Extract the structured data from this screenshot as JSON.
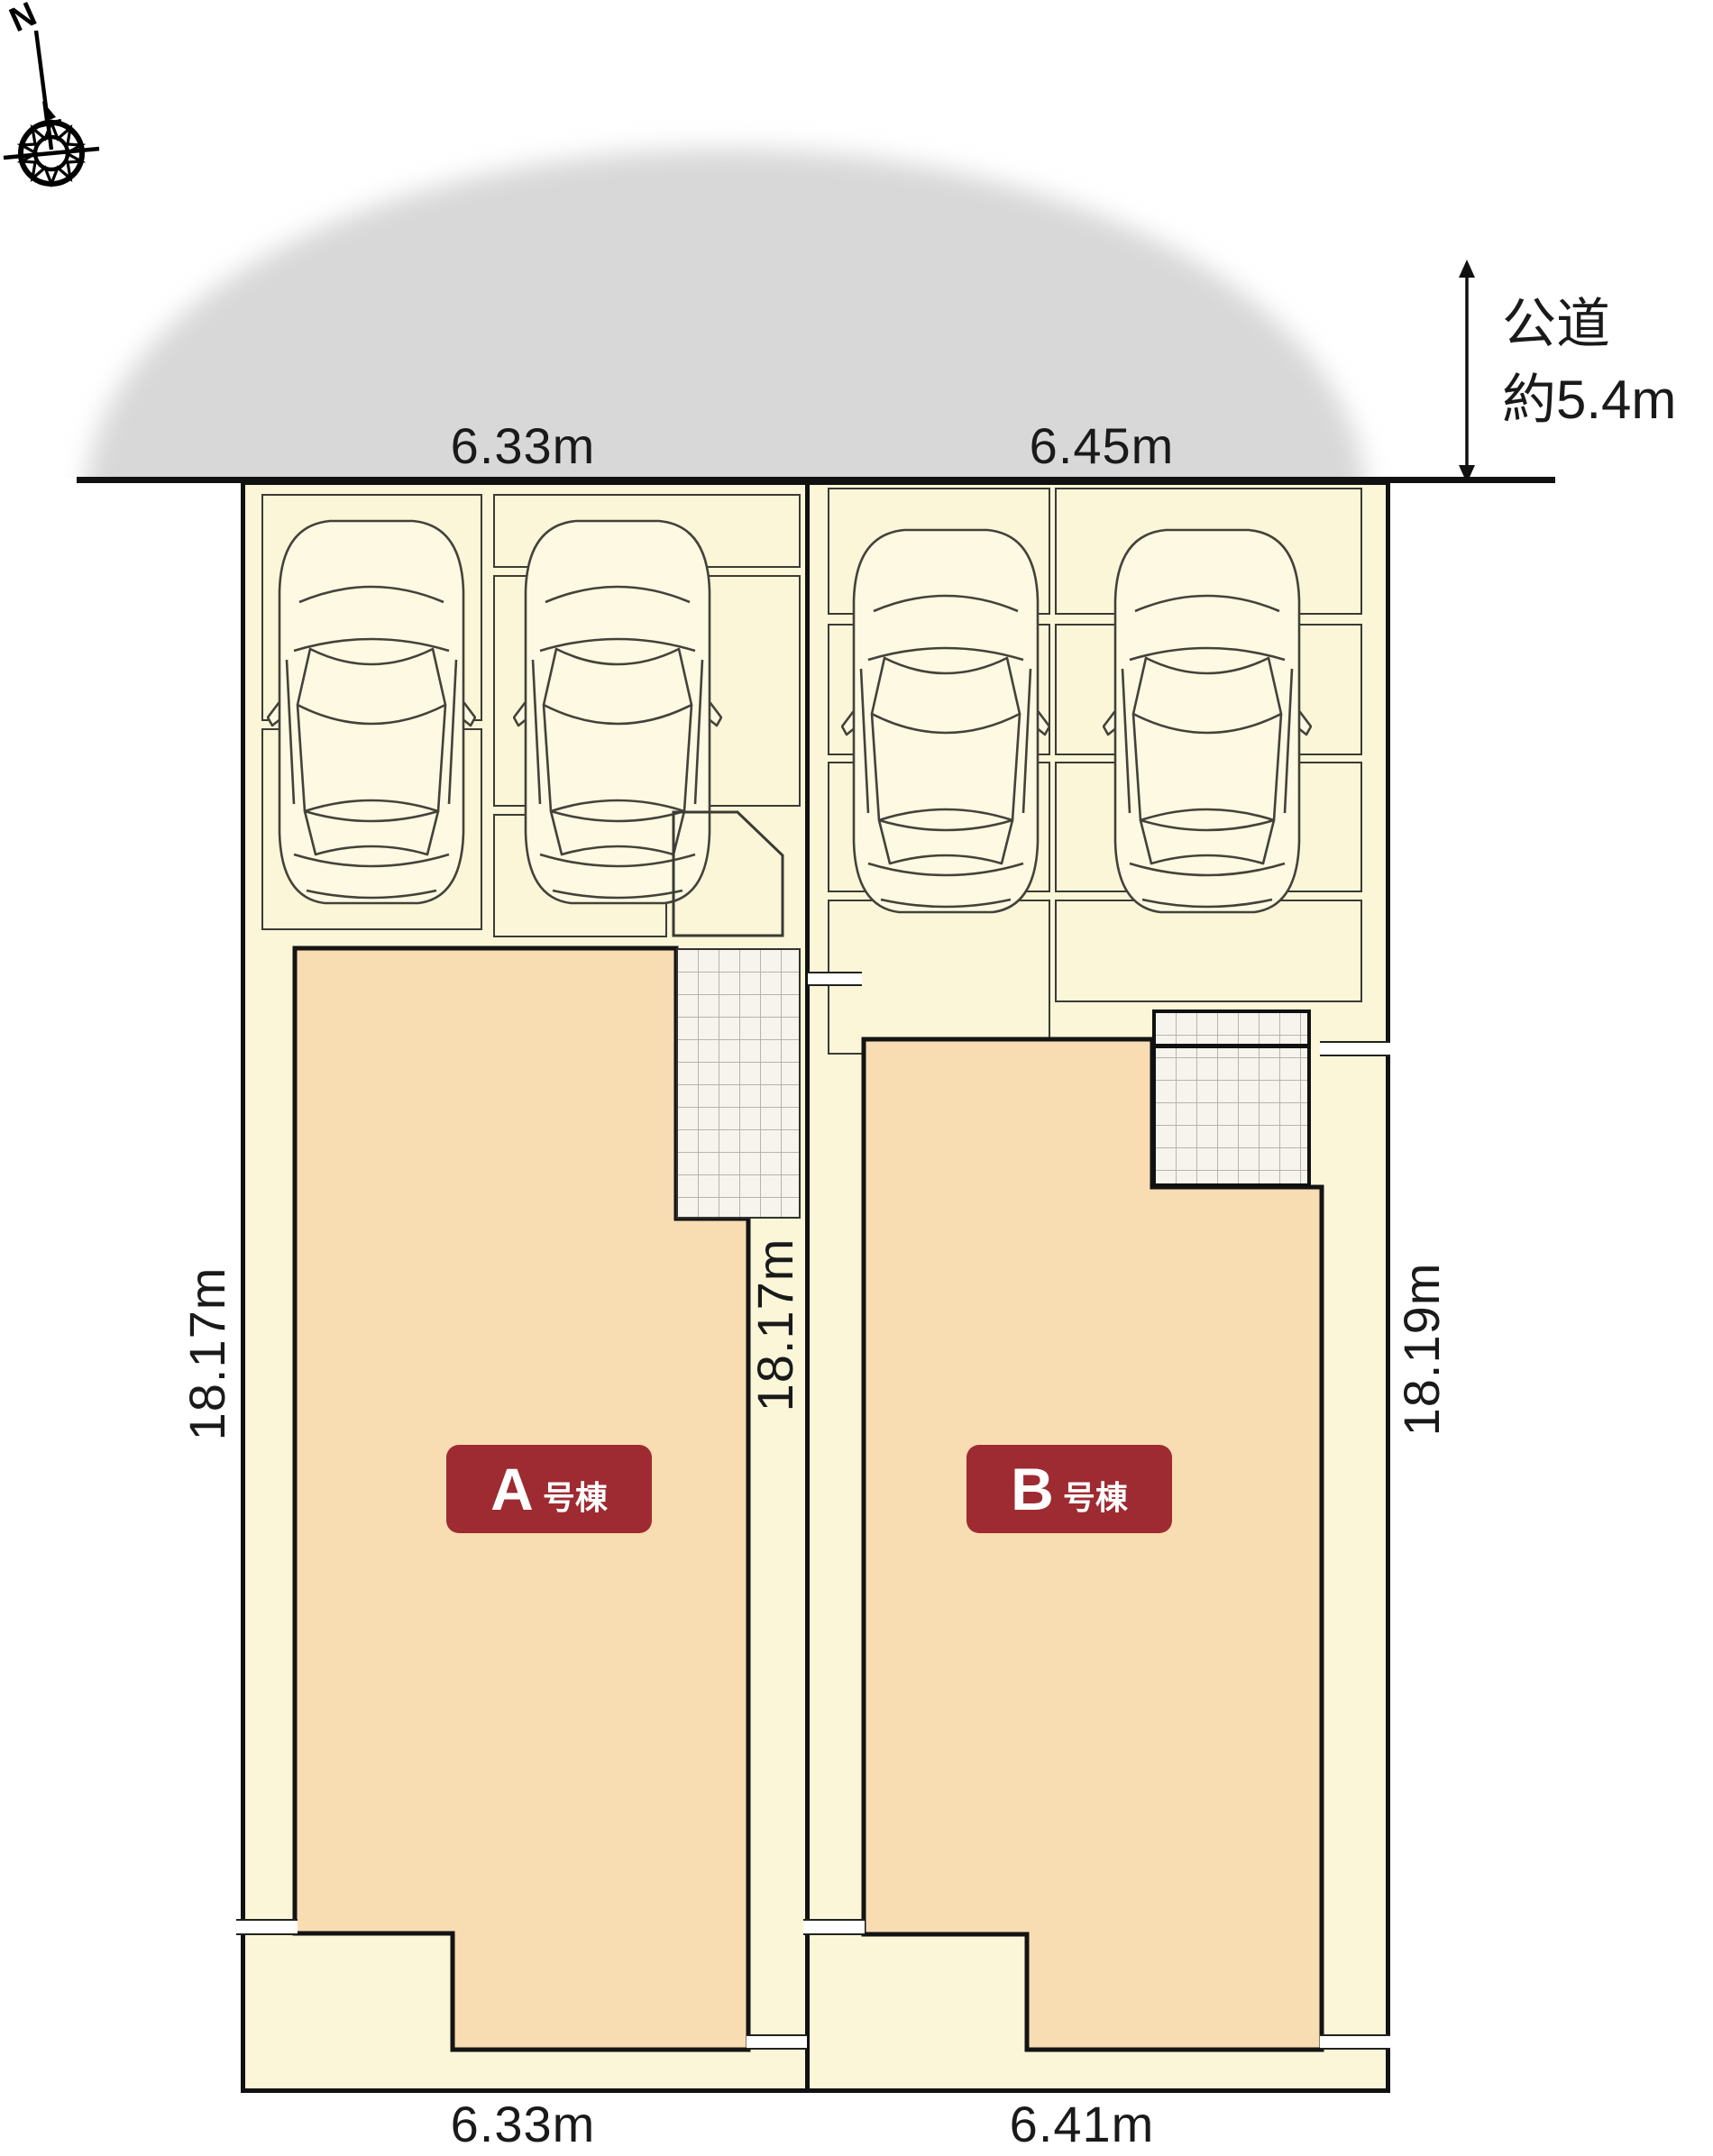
{
  "compass": {
    "north": "N"
  },
  "road": {
    "label_line1": "公道",
    "label_line2": "約5.4m"
  },
  "dimensions": {
    "lot_a_top": "6.33m",
    "lot_b_top": "6.45m",
    "lot_a_bottom": "6.33m",
    "lot_b_bottom": "6.41m",
    "lot_a_left": "18.17m",
    "lot_a_right": "18.17m",
    "lot_b_right": "18.19m"
  },
  "buildings": {
    "a": {
      "letter": "A",
      "suffix": "号棟"
    },
    "b": {
      "letter": "B",
      "suffix": "号棟"
    }
  },
  "colors": {
    "site_fill": "#fbf6d8",
    "building_fill": "#f8dcb2",
    "badge_red": "#9e2b31",
    "road_gray": "#d8d8d8",
    "line_black": "#111111"
  }
}
